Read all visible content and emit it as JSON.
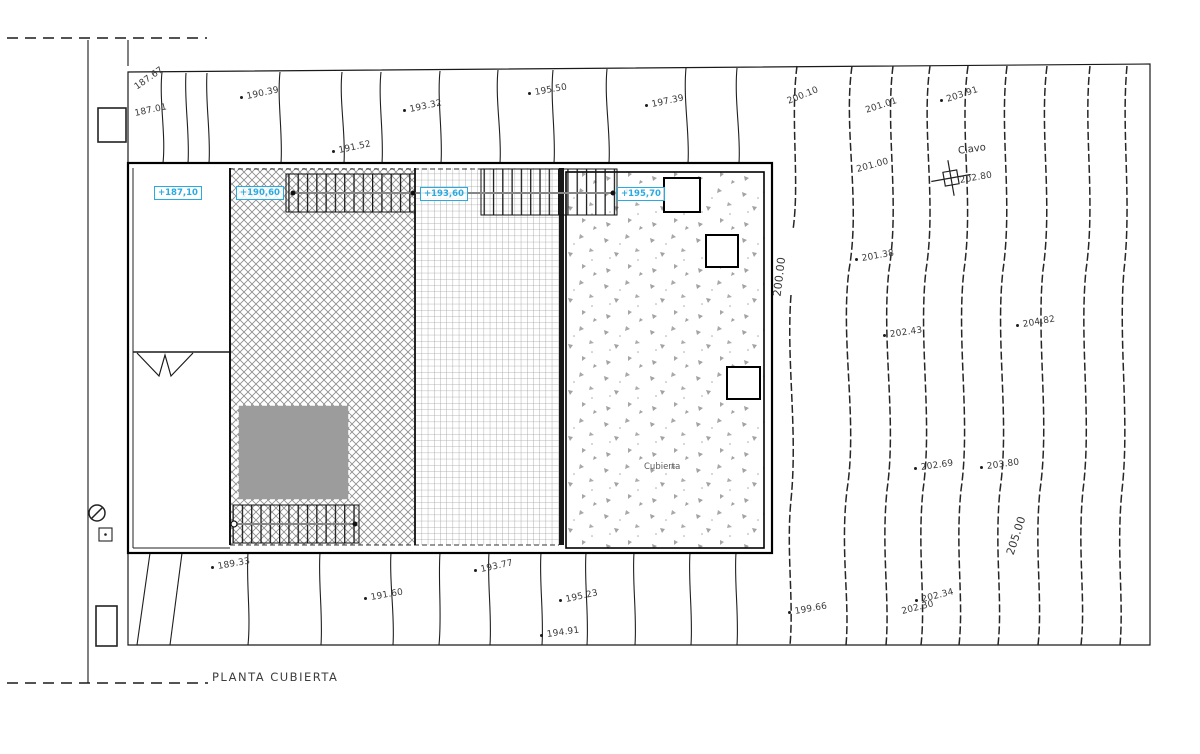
{
  "drawing": {
    "title": "PLANTA CUBIERTA",
    "area_label": "Cubierta",
    "benchmark_label": "Clavo"
  },
  "colors": {
    "accent_cyan": "#29abe2",
    "line": "#1a1a1a",
    "roof_gray_fill": "#9c9c9c",
    "hatch_gray": "#8f8f8f"
  },
  "elevation_tags": [
    {
      "text": "+187,10",
      "x": 154,
      "y": 186
    },
    {
      "text": "+190,60",
      "x": 236,
      "y": 186
    },
    {
      "text": "+193,60",
      "x": 420,
      "y": 187
    },
    {
      "text": "+195,70",
      "x": 617,
      "y": 187
    }
  ],
  "contour_labels": [
    {
      "text": "187.67",
      "x": 136,
      "y": 84,
      "rot": -35,
      "dot": false
    },
    {
      "text": "187.01",
      "x": 135,
      "y": 110,
      "rot": -12,
      "dot": false
    },
    {
      "text": "190.39",
      "x": 247,
      "y": 93,
      "rot": -12,
      "dot": true
    },
    {
      "text": "191.52",
      "x": 339,
      "y": 147,
      "rot": -12,
      "dot": true
    },
    {
      "text": "193.32",
      "x": 410,
      "y": 106,
      "rot": -12,
      "dot": true
    },
    {
      "text": "195.50",
      "x": 535,
      "y": 89,
      "rot": -10,
      "dot": true
    },
    {
      "text": "197.39",
      "x": 652,
      "y": 101,
      "rot": -12,
      "dot": true
    },
    {
      "text": "200.10",
      "x": 788,
      "y": 98,
      "rot": -22,
      "dot": false
    },
    {
      "text": "201.01",
      "x": 866,
      "y": 107,
      "rot": -18,
      "dot": false
    },
    {
      "text": "203.91",
      "x": 947,
      "y": 96,
      "rot": -18,
      "dot": true
    },
    {
      "text": "201.00",
      "x": 857,
      "y": 166,
      "rot": -15,
      "dot": false
    },
    {
      "text": "202.80",
      "x": 960,
      "y": 177,
      "rot": -10,
      "dot": false
    },
    {
      "text": "201.38",
      "x": 862,
      "y": 255,
      "rot": -10,
      "dot": true
    },
    {
      "text": "202.43",
      "x": 890,
      "y": 331,
      "rot": -8,
      "dot": true
    },
    {
      "text": "204.82",
      "x": 1023,
      "y": 321,
      "rot": -10,
      "dot": true
    },
    {
      "text": "202.69",
      "x": 921,
      "y": 464,
      "rot": -8,
      "dot": true
    },
    {
      "text": "203.80",
      "x": 987,
      "y": 463,
      "rot": -8,
      "dot": true
    },
    {
      "text": "200.00",
      "x": 777,
      "y": 291,
      "rot": -83,
      "dot": false,
      "size": 11
    },
    {
      "text": "205.00",
      "x": 1010,
      "y": 549,
      "rot": -72,
      "dot": false,
      "size": 11
    },
    {
      "text": "189.33",
      "x": 218,
      "y": 563,
      "rot": -10,
      "dot": true
    },
    {
      "text": "191.60",
      "x": 371,
      "y": 594,
      "rot": -10,
      "dot": true
    },
    {
      "text": "193.77",
      "x": 481,
      "y": 566,
      "rot": -12,
      "dot": true
    },
    {
      "text": "195.23",
      "x": 566,
      "y": 596,
      "rot": -12,
      "dot": true
    },
    {
      "text": "194.91",
      "x": 547,
      "y": 631,
      "rot": -8,
      "dot": true
    },
    {
      "text": "199.66",
      "x": 795,
      "y": 608,
      "rot": -10,
      "dot": true
    },
    {
      "text": "202.30",
      "x": 902,
      "y": 608,
      "rot": -14,
      "dot": false
    },
    {
      "text": "202.34",
      "x": 922,
      "y": 596,
      "rot": -14,
      "dot": true
    }
  ]
}
